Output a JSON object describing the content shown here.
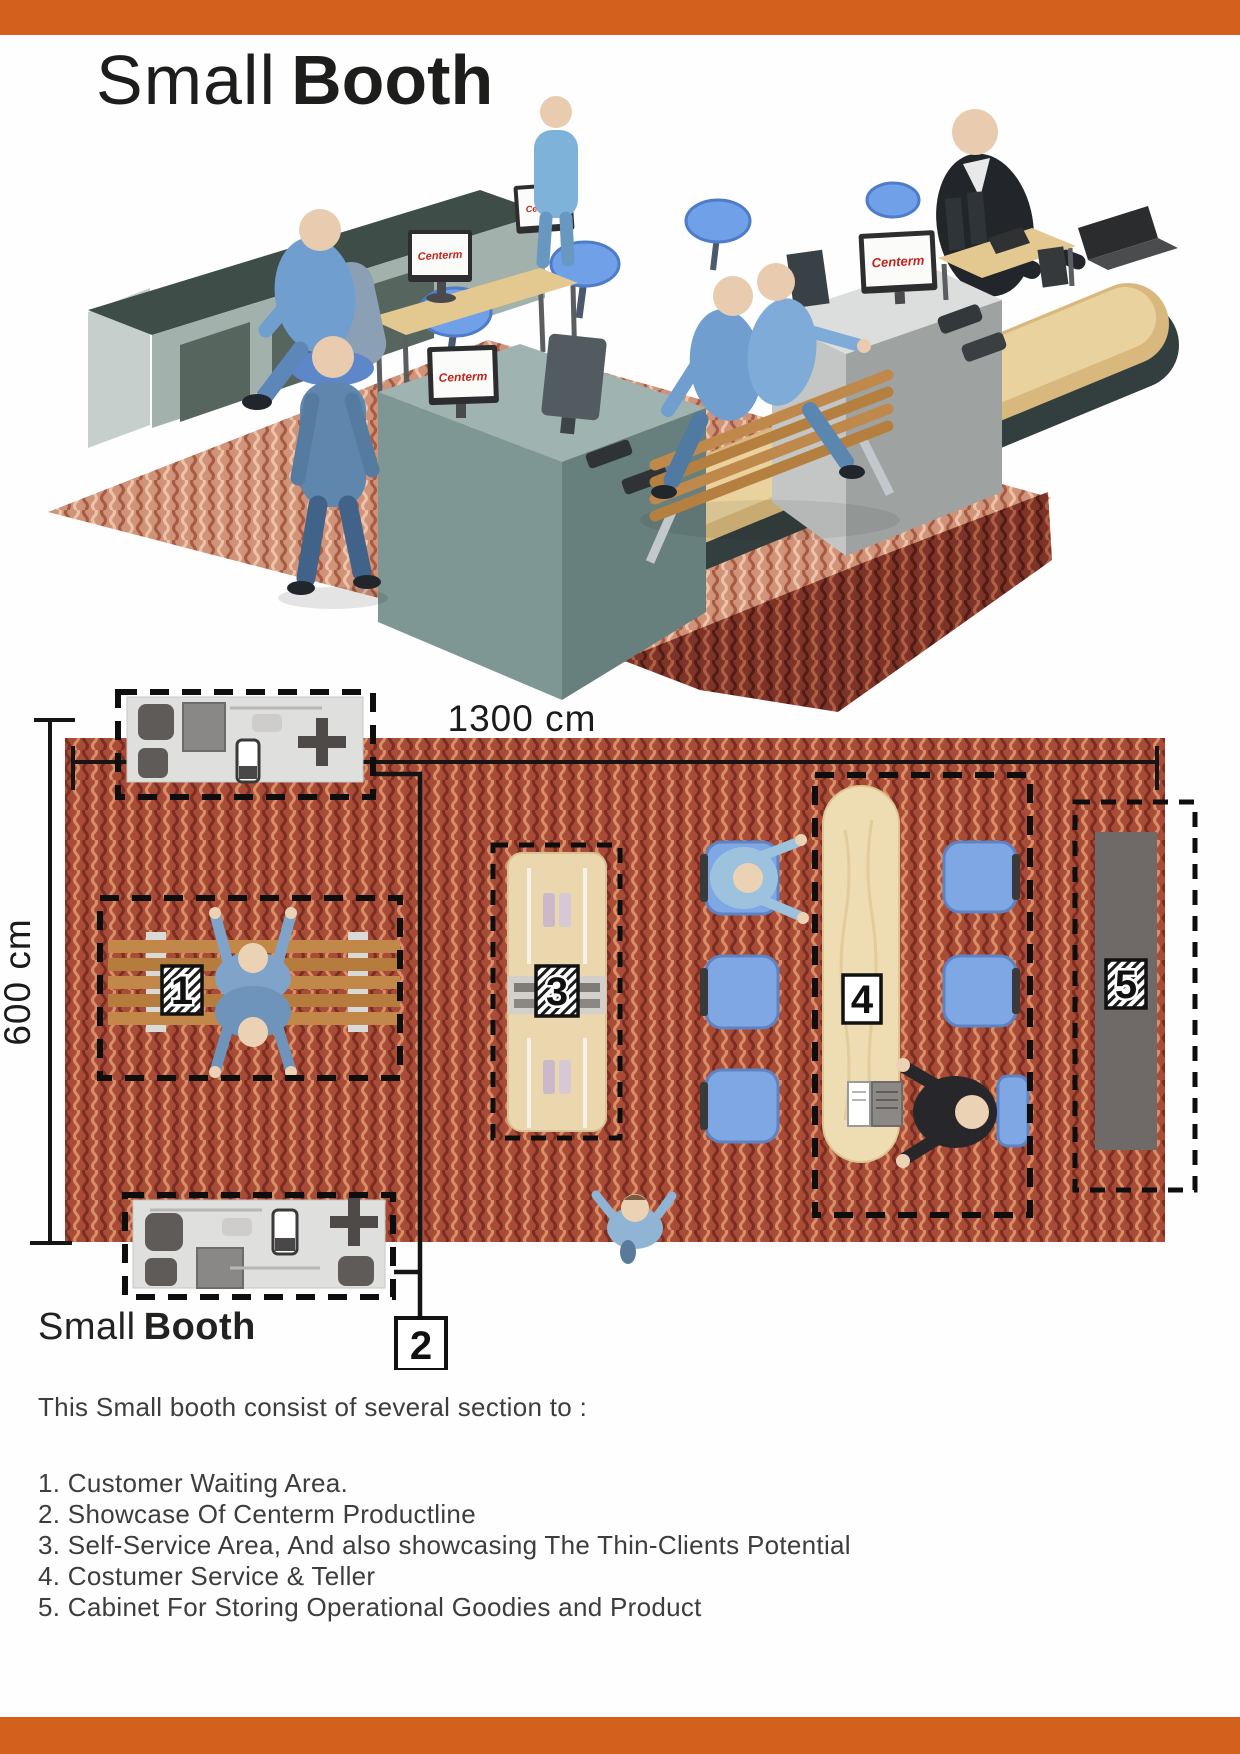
{
  "page": {
    "accent_color": "#d4601d",
    "title": {
      "light": "Small",
      "bold": "Booth"
    }
  },
  "render": {
    "brand": "Centerm"
  },
  "plan": {
    "width_label": "1300 cm",
    "height_label": "600 cm",
    "areas": {
      "waiting": "1",
      "showcase": "2",
      "self_service": "3",
      "teller": "4",
      "cabinet": "5"
    }
  },
  "caption": {
    "light": "Small",
    "bold": "Booth"
  },
  "description": {
    "intro": "This Small booth consist of several section to :",
    "items": [
      "1. Customer Waiting Area.",
      "2. Showcase Of Centerm Productline",
      "3. Self-Service Area, And also showcasing The Thin-Clients Potential",
      "4. Costumer Service & Teller",
      "5. Cabinet For Storing Operational Goodies and Product"
    ]
  }
}
